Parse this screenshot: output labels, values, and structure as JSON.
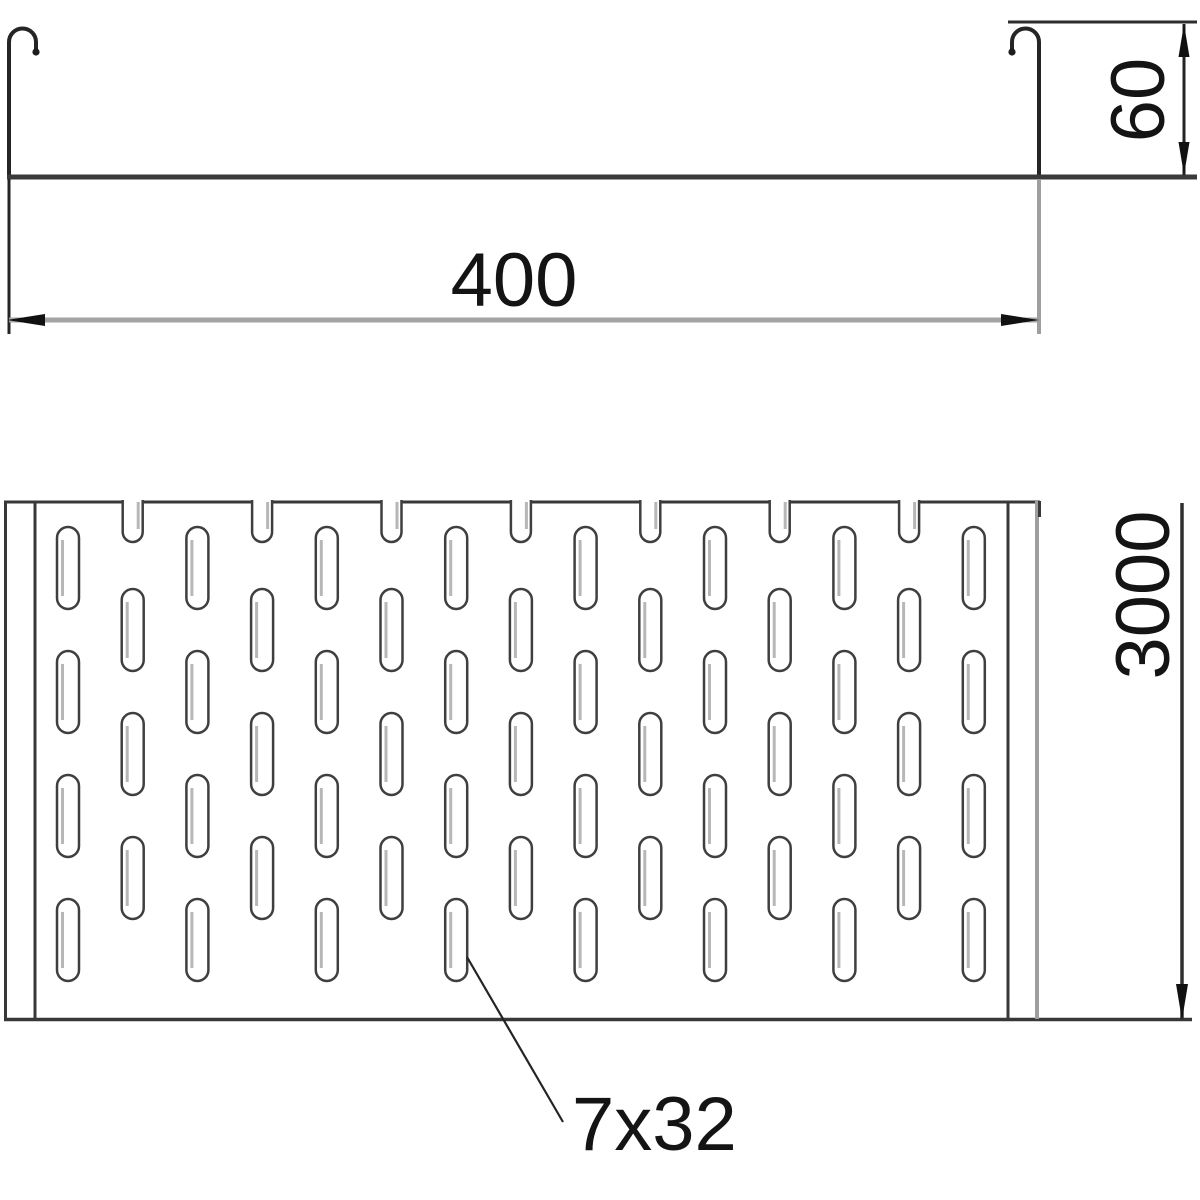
{
  "diagram": {
    "dimensions": {
      "width_mm": "400",
      "height_mm": "60",
      "length_mm": "3000",
      "slot_size": "7x32"
    },
    "colors": {
      "line_dark": "#2a2a2a",
      "line_medium": "#3a3a3a",
      "line_gray": "#9e9e9e",
      "slot_stroke": "#3f3f3f",
      "slot_shade": "#b7b7b7"
    }
  }
}
